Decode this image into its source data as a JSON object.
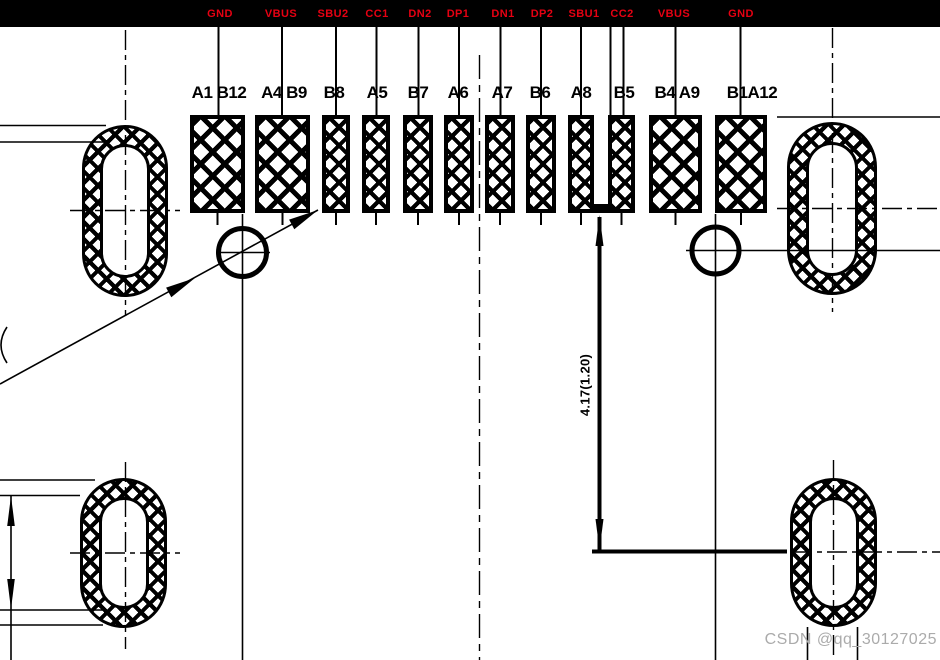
{
  "signals": [
    {
      "name": "GND"
    },
    {
      "name": "VBUS"
    },
    {
      "name": "SBU2"
    },
    {
      "name": "CC1"
    },
    {
      "name": "DN2"
    },
    {
      "name": "DP1"
    },
    {
      "name": "DN1"
    },
    {
      "name": "DP2"
    },
    {
      "name": "SBU1"
    },
    {
      "name": "CC2"
    },
    {
      "name": "VBUS"
    },
    {
      "name": "GND"
    }
  ],
  "pins": [
    {
      "label": "A1 B12"
    },
    {
      "label": "A4 B9"
    },
    {
      "label": "B8"
    },
    {
      "label": "A5"
    },
    {
      "label": "B7"
    },
    {
      "label": "A6"
    },
    {
      "label": "A7"
    },
    {
      "label": "B6"
    },
    {
      "label": "A8"
    },
    {
      "label": "B5"
    },
    {
      "label": "B4 A9"
    },
    {
      "label": "B1A12"
    }
  ],
  "dimension_vertical": {
    "text": "4.17(1.20)"
  },
  "watermark": {
    "text": "CSDN @qq_30127025"
  },
  "colors": {
    "ink": "#000000",
    "signal_label": "#e60012",
    "watermark": "#ababab",
    "background": "#ffffff"
  }
}
